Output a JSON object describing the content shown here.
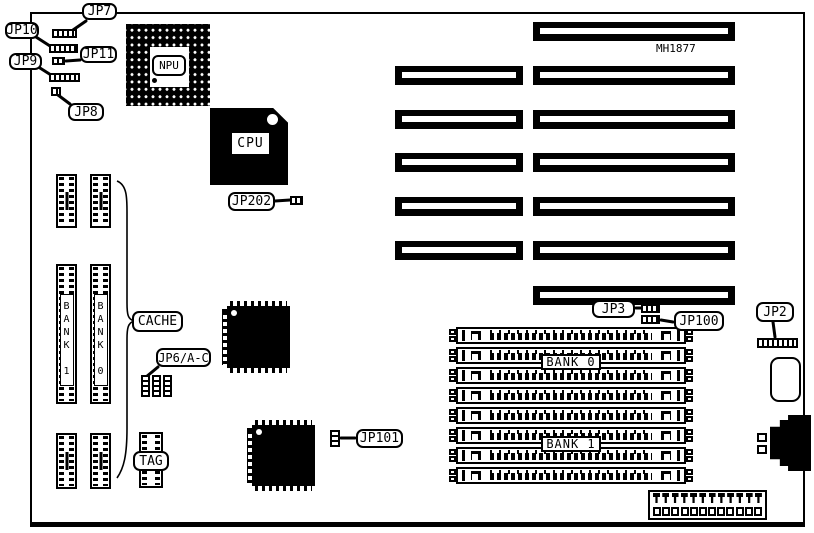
{
  "board": {
    "model_text": "MH1877"
  },
  "chips": {
    "npu": "NPU",
    "cpu": "CPU",
    "cache_label": "CACHE",
    "tag_label": "TAG",
    "cache_bank_left": "BANK 1",
    "cache_bank_right": "BANK 0"
  },
  "jumpers": {
    "jp7": "JP7",
    "jp10": "JP10",
    "jp11": "JP11",
    "jp9": "JP9",
    "jp8": "JP8",
    "jp202": "JP202",
    "jp6ac": "JP6/A-C",
    "jp101": "JP101",
    "jp3": "JP3",
    "jp100": "JP100",
    "jp2": "JP2"
  },
  "memory": {
    "bank0_label": "BANK 0",
    "bank1_label": "BANK 1",
    "simm_socket_count": 8
  },
  "expansion": {
    "slot_row_count": 7
  },
  "connectors": {
    "power_pin_count": 12
  }
}
